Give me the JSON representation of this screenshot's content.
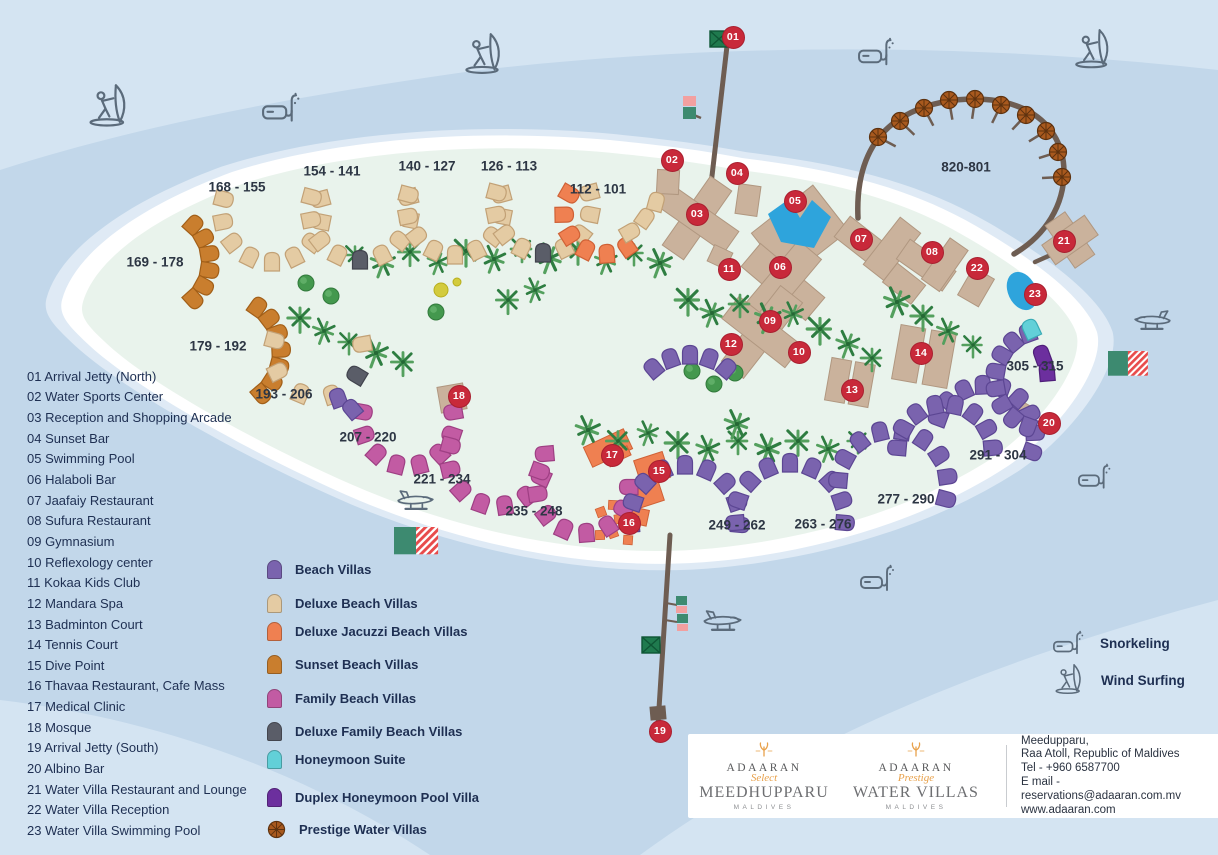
{
  "facilities": [
    {
      "num": "01",
      "name": "Arrival Jetty (North)"
    },
    {
      "num": "02",
      "name": "Water Sports Center"
    },
    {
      "num": "03",
      "name": "Reception and Shopping Arcade"
    },
    {
      "num": "04",
      "name": "Sunset Bar"
    },
    {
      "num": "05",
      "name": "Swimming Pool"
    },
    {
      "num": "06",
      "name": "Halaboli Bar"
    },
    {
      "num": "07",
      "name": "Jaafaiy Restaurant"
    },
    {
      "num": "08",
      "name": "Sufura Restaurant"
    },
    {
      "num": "09",
      "name": "Gymnasium"
    },
    {
      "num": "10",
      "name": "Reflexology center"
    },
    {
      "num": "11",
      "name": "Kokaa Kids Club"
    },
    {
      "num": "12",
      "name": "Mandara Spa"
    },
    {
      "num": "13",
      "name": "Badminton Court"
    },
    {
      "num": "14",
      "name": "Tennis Court"
    },
    {
      "num": "15",
      "name": "Dive Point"
    },
    {
      "num": "16",
      "name": "Thavaa Restaurant, Cafe Mass"
    },
    {
      "num": "17",
      "name": "Medical Clinic"
    },
    {
      "num": "18",
      "name": "Mosque"
    },
    {
      "num": "19",
      "name": "Arrival Jetty (South)"
    },
    {
      "num": "20",
      "name": "Albino Bar"
    },
    {
      "num": "21",
      "name": "Water Villa Restaurant and Lounge"
    },
    {
      "num": "22",
      "name": "Water Villa Reception"
    },
    {
      "num": "23",
      "name": "Water Villa Swimming Pool"
    }
  ],
  "legend": {
    "items": [
      {
        "key": "bv",
        "label": "Beach Villas",
        "color": "#7a63ae",
        "border": "#5c4693"
      },
      {
        "key": "dbv",
        "label": "Deluxe Beach Villas",
        "color": "#e4cba3",
        "border": "#c2a176"
      },
      {
        "key": "djv",
        "label": "Deluxe Jacuzzi Beach Villas",
        "color": "#ef8051",
        "border": "#cf6136"
      },
      {
        "key": "sbv",
        "label": "Sunset Beach Villas",
        "color": "#c97e2e",
        "border": "#a25f18"
      },
      {
        "key": "fbv",
        "label": "Family Beach Villas",
        "color": "#c25ba3",
        "border": "#9e3f83"
      },
      {
        "key": "dfv",
        "label": "Deluxe Family Beach Villas",
        "color": "#5a5d68",
        "border": "#41434d"
      },
      {
        "key": "hs",
        "label": "Honeymoon Suite",
        "color": "#62d0d8",
        "border": "#3aacb6"
      },
      {
        "key": "dhv",
        "label": "Duplex Honeymoon Pool Villa",
        "color": "#6c2f9e",
        "border": "#4f1f79"
      },
      {
        "key": "pwv",
        "label": "Prestige Water Villas",
        "color": "#a8591e",
        "border": "#5e320f",
        "icon": "umbrella"
      }
    ]
  },
  "villa_labels": [
    "168 - 155",
    "154 - 141",
    "140 - 127",
    "126 - 113",
    "112 - 101",
    "169 - 178",
    "179 - 192",
    "193 - 206",
    "207 - 220",
    "221 - 234",
    "235 - 248",
    "249 - 262",
    "263 - 276",
    "277 - 290",
    "291 - 304",
    "305 - 315",
    "820-801"
  ],
  "markers": [
    "01",
    "02",
    "03",
    "04",
    "05",
    "06",
    "07",
    "08",
    "09",
    "10",
    "11",
    "12",
    "13",
    "14",
    "15",
    "16",
    "17",
    "18",
    "19",
    "20",
    "21",
    "22",
    "23"
  ],
  "activities": [
    {
      "label": "Snorkeling",
      "icon": "snorkel-icon"
    },
    {
      "label": "Wind Surfing",
      "icon": "windsurf-icon"
    }
  ],
  "footer": {
    "brand_select": {
      "name": "ADAARAN",
      "tier": "Select",
      "resort": "MEEDHUPPARU",
      "country": "MALDIVES"
    },
    "brand_prestige": {
      "name": "ADAARAN",
      "tier": "Prestige",
      "resort": "WATER VILLAS",
      "country": "MALDIVES"
    },
    "address_lines": [
      "Meedupparu,",
      "Raa Atoll, Republic of Maldives",
      "Tel - +960 6587700",
      "E mail - reservations@adaaran.com.mv",
      "www.adaaran.com"
    ]
  },
  "colors": {
    "marker": "#c8293a",
    "sea": "#c2d7ea",
    "sea_light": "#d4e4f2",
    "halo": "#dfeaf5",
    "sand": "#ffffff",
    "island": "#e9f3ec",
    "pier": "#6e5d52",
    "pool": "#2ea4dc",
    "building": "#cab29c",
    "building_border": "#b09780",
    "text": "#1e2f52",
    "flag_green": "#3d8a70",
    "flag_red": "#e84b4b",
    "icon_gray": "#5b6b7b"
  }
}
